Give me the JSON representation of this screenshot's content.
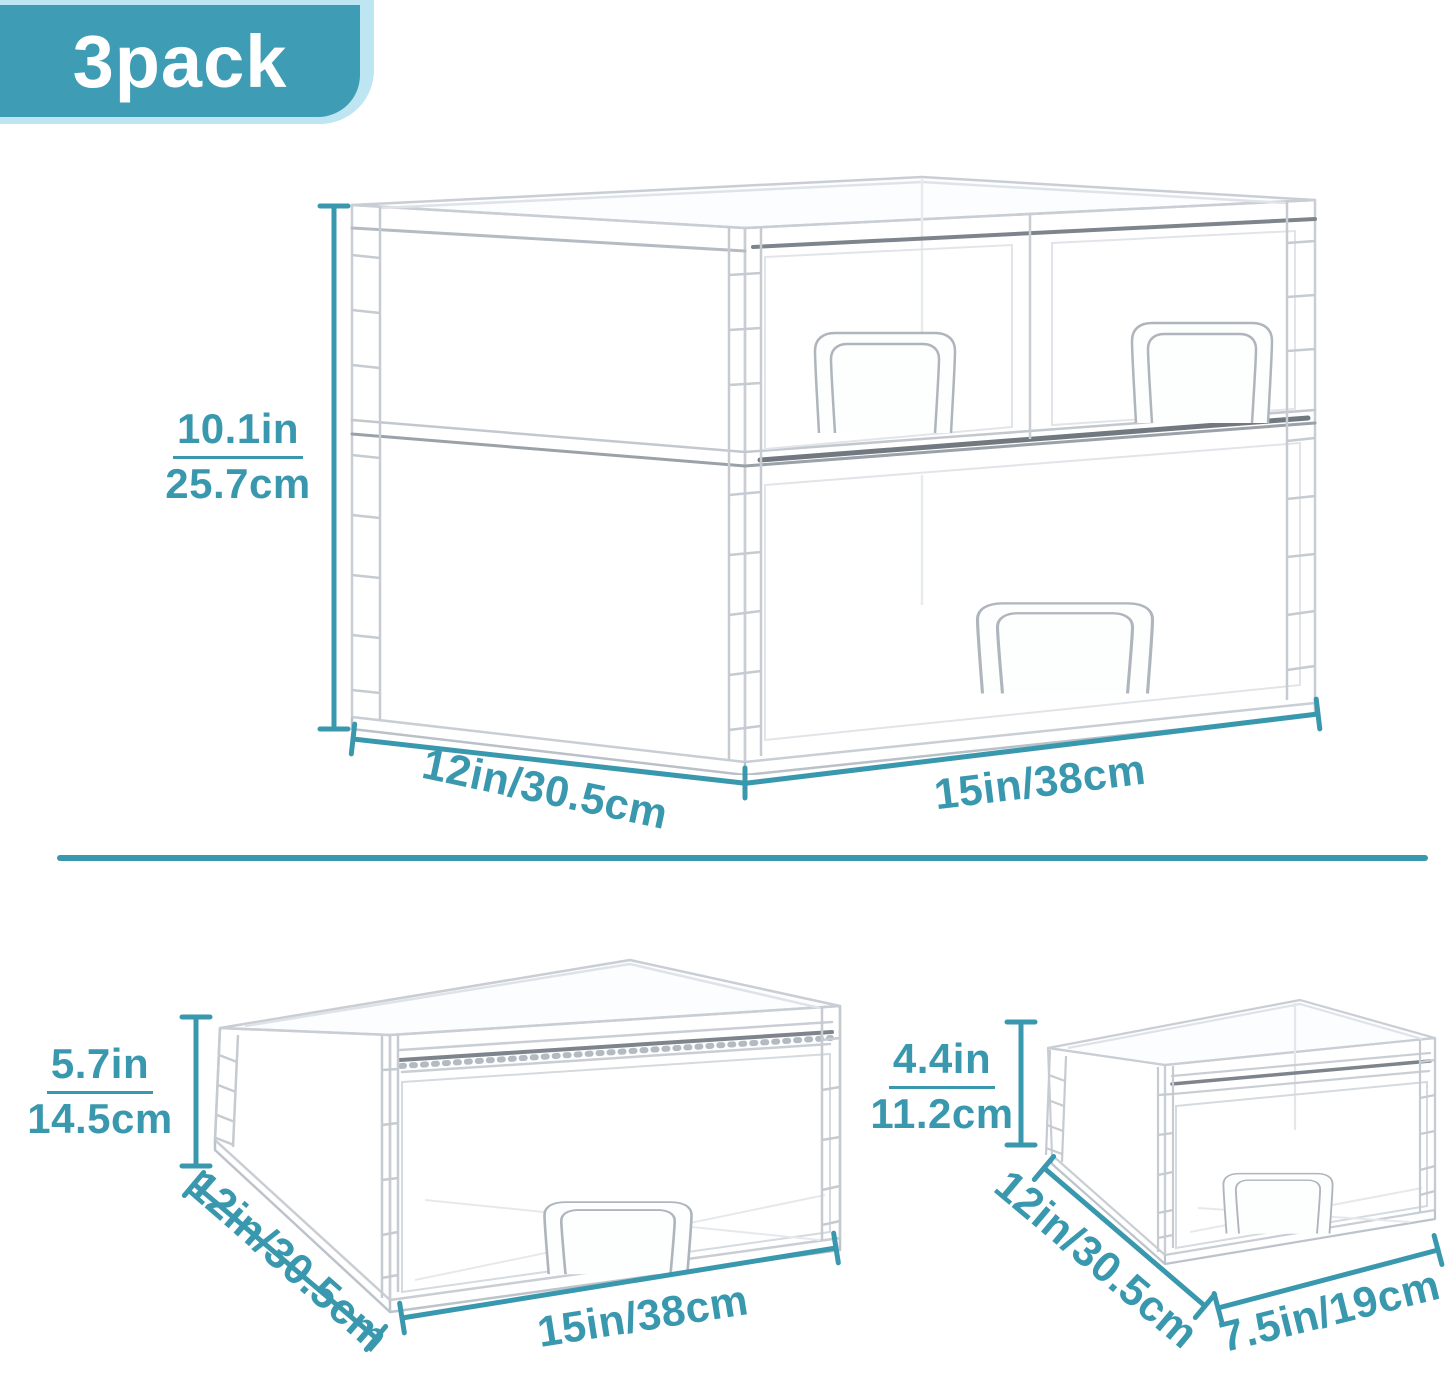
{
  "badge": {
    "label": "3pack"
  },
  "colors": {
    "accent": "#3A98AE",
    "badge_bg": "#3E9DB4",
    "badge_ring": "#BDE6F2",
    "line_gray": "#C9CED4"
  },
  "products": {
    "stacked": {
      "description": "2-tier stacked clear organizer",
      "height_in": "10.1in",
      "height_cm": "25.7cm",
      "depth": "12in/30.5cm",
      "width": "15in/38cm"
    },
    "large": {
      "description": "large single clear drawer",
      "height_in": "5.7in",
      "height_cm": "14.5cm",
      "depth": "12in/30.5cm",
      "width": "15in/38cm"
    },
    "small": {
      "description": "small single clear drawer",
      "height_in": "4.4in",
      "height_cm": "11.2cm",
      "depth": "12in/30.5cm",
      "width": "7.5in/19cm"
    }
  }
}
